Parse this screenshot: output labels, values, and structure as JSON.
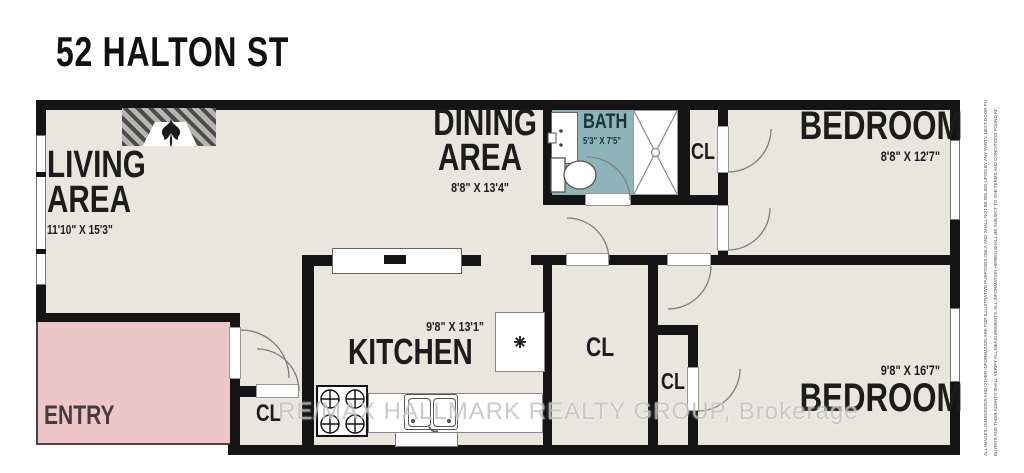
{
  "title": "52 HALTON ST",
  "rooms": {
    "living": {
      "line1": "LIVING",
      "line2": "AREA",
      "dims": "11'10\" X 15'3\""
    },
    "dining": {
      "line1": "DINING",
      "line2": "AREA",
      "dims": "8'8\" X 13'4\""
    },
    "bath": {
      "label": "BATH",
      "dims": "5'3\" X 7'5\""
    },
    "kitchen": {
      "label": "KITCHEN",
      "dims": "9'8\" X 13'1\""
    },
    "bedroom1": {
      "label": "BEDROOM",
      "dims": "8'8\" X 12'7\""
    },
    "bedroom2": {
      "label": "BEDROOM",
      "dims": "9'8\" X 16'7\""
    },
    "entry": {
      "label": "ENTRY"
    }
  },
  "labels": {
    "closet": "CL"
  },
  "watermark": {
    "text": "RE/MAX HALLMARK REALTY GROUP, Brokerage"
  },
  "fine_print": {
    "line1": "ALL IMAGES, DIMENSIONS AND OTHER INFORMATION ARE FOR ILLUSTRATIVE PURPOSES ONLY, AND SHALL NOT BE RELIED UPON BY ANY PARTY. NEXT DOOR PHOTOS IN",
    "link": "STRATA.DRAWINGS",
    "line2": "BUYERS AND THEIR AGENTS SHALL VERIFY ALL MEASUREMENTS. ALL INFORMATION HEREIN SHALL BE SUBJECT TO THE TERMS AND CONDITIONS FOUND AT"
  },
  "colors": {
    "floor": "#e8e6dd",
    "wall": "#141414",
    "bath_floor": "#8db4bb",
    "entry_floor": "#eec6c8",
    "watermark": "#c2c2c2",
    "fine_print_link": "#2196d6"
  }
}
